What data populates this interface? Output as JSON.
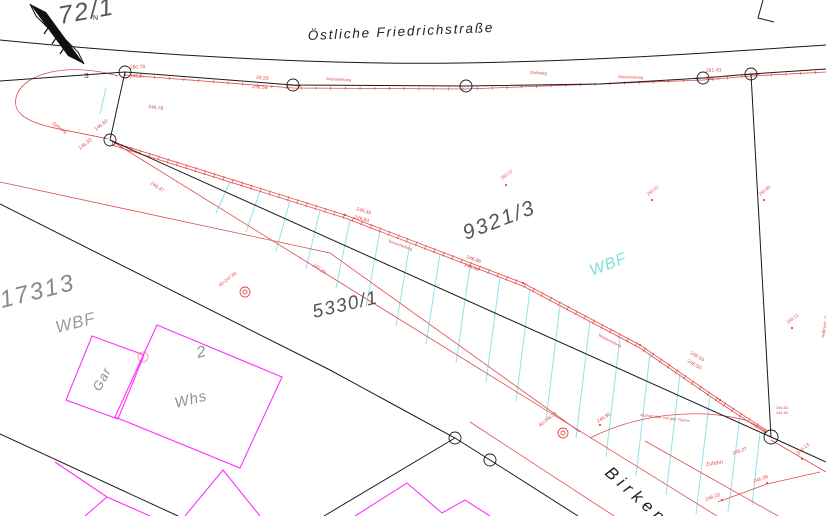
{
  "map": {
    "streets": {
      "top": "Östliche Friedrichstraße",
      "bottom": "Birkenf"
    },
    "parcels": {
      "p72_1": "72/1",
      "p9321_3": "9321/3",
      "p5330_1": "5330/1",
      "p17313": "17313"
    },
    "usage": {
      "wbf_gray": "WBF",
      "wbf_cyan": "WBF"
    },
    "buildings": {
      "garage": "Gar",
      "house_number": "2",
      "house": "Whs"
    },
    "compass": {
      "north": "N",
      "south": "S"
    },
    "colors": {
      "line_black": "#1a1a1a",
      "line_red": "#e14b4b",
      "building_magenta": "#ff30ff",
      "hatch_cyan": "#8fe3ea",
      "label_gray": "#8a8a8a",
      "wbf_cyan_color": "#7fe0e0"
    },
    "annotations": [
      {
        "t": "260.76",
        "x": 130,
        "y": 69,
        "r": -4
      },
      {
        "t": "246.27",
        "x": 130,
        "y": 78,
        "r": -4
      },
      {
        "t": "29.29",
        "x": 256,
        "y": 79,
        "r": 4
      },
      {
        "t": "298.58",
        "x": 252,
        "y": 88,
        "r": 4
      },
      {
        "t": "Wasserleitung",
        "x": 326,
        "y": 80,
        "r": 3,
        "s": 4
      },
      {
        "t": "Gehweg",
        "x": 530,
        "y": 74,
        "r": 2,
        "s": 4.5
      },
      {
        "t": "Wasserleitung",
        "x": 618,
        "y": 78,
        "r": 2,
        "s": 4
      },
      {
        "t": "261.43",
        "x": 706,
        "y": 72,
        "r": -2
      },
      {
        "t": "261.17",
        "x": 706,
        "y": 80,
        "r": -2
      },
      {
        "t": "246.76",
        "x": 148,
        "y": 108,
        "r": 8
      },
      {
        "t": "146.60",
        "x": 96,
        "y": 131,
        "r": -38
      },
      {
        "t": "146.03",
        "x": 80,
        "y": 150,
        "r": -38
      },
      {
        "t": "Gehweg",
        "x": 52,
        "y": 124,
        "r": 36,
        "s": 4.5
      },
      {
        "t": "246.47",
        "x": 150,
        "y": 184,
        "r": 33
      },
      {
        "t": "247.20",
        "x": 312,
        "y": 266,
        "r": 33
      },
      {
        "t": "246.36",
        "x": 356,
        "y": 210,
        "r": 17
      },
      {
        "t": "246.84",
        "x": 354,
        "y": 218,
        "r": 17
      },
      {
        "t": "Wasserleitung",
        "x": 388,
        "y": 242,
        "r": 20,
        "s": 4
      },
      {
        "t": "246.86",
        "x": 466,
        "y": 258,
        "r": 20
      },
      {
        "t": "246.84",
        "x": 464,
        "y": 266,
        "r": 20
      },
      {
        "t": "Wasserleitung",
        "x": 598,
        "y": 336,
        "r": 27,
        "s": 4
      },
      {
        "t": "246.55",
        "x": 690,
        "y": 354,
        "r": 30
      },
      {
        "t": "246.50",
        "x": 687,
        "y": 362,
        "r": 30
      },
      {
        "t": "250.22",
        "x": 502,
        "y": 180,
        "r": -38,
        "s": 4.5
      },
      {
        "t": "250.12",
        "x": 648,
        "y": 196,
        "r": -38,
        "s": 4.5
      },
      {
        "t": "250.85",
        "x": 760,
        "y": 196,
        "r": -38,
        "s": 4.5
      },
      {
        "t": "249.12",
        "x": 788,
        "y": 324,
        "r": -38,
        "s": 4.5
      },
      {
        "t": "wahrsch. Grenze",
        "x": 824,
        "y": 338,
        "r": -80,
        "s": 4.5
      },
      {
        "t": "40=247.83",
        "x": 220,
        "y": 287,
        "r": -38,
        "s": 4.5
      },
      {
        "t": "40=248.39",
        "x": 540,
        "y": 427,
        "r": -38,
        "s": 4.5
      },
      {
        "t": "246.80",
        "x": 598,
        "y": 423,
        "r": -32
      },
      {
        "t": "Asphalt über. voll geb. Fläche",
        "x": 640,
        "y": 416,
        "r": 7,
        "s": 3.8
      },
      {
        "t": "Zufahrt",
        "x": 706,
        "y": 466,
        "r": -8,
        "s": 5.5
      },
      {
        "t": "246.27",
        "x": 733,
        "y": 455,
        "r": -20
      },
      {
        "t": "246.22",
        "x": 706,
        "y": 501,
        "r": -20
      },
      {
        "t": "246.38",
        "x": 754,
        "y": 483,
        "r": -20
      },
      {
        "t": "246.13",
        "x": 798,
        "y": 455,
        "r": -40
      },
      {
        "t": "246.53",
        "x": 776,
        "y": 409,
        "r": 0,
        "s": 4
      },
      {
        "t": "246.62",
        "x": 776,
        "y": 414,
        "r": 0,
        "s": 4
      }
    ]
  }
}
